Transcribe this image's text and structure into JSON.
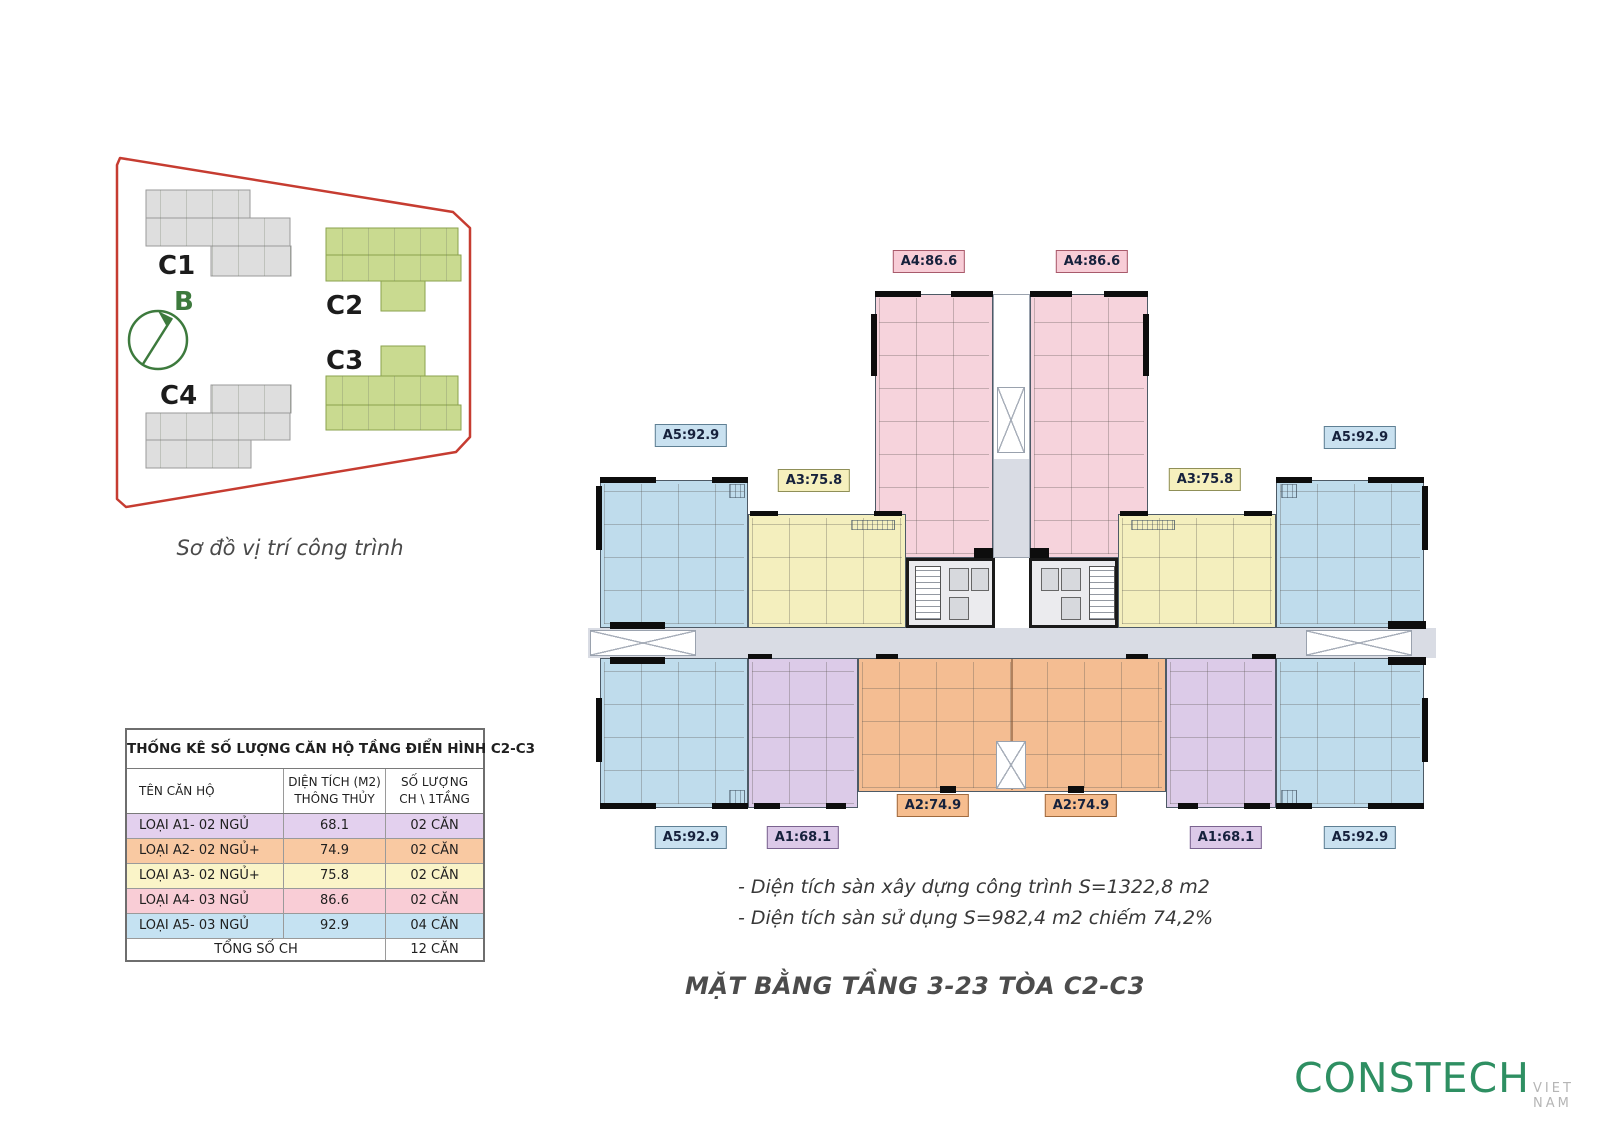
{
  "site": {
    "caption": "Sơ đồ vị trí công trình",
    "compass_label": "B",
    "buildings": [
      {
        "id": "C1",
        "style": "gray"
      },
      {
        "id": "C2",
        "style": "green"
      },
      {
        "id": "C3",
        "style": "green"
      },
      {
        "id": "C4",
        "style": "gray"
      }
    ],
    "boundary_color": "#c63c31"
  },
  "table": {
    "title": "THỐNG KÊ SỐ LƯỢNG CĂN HỘ TẦNG ĐIỂN HÌNH C2-C3",
    "col1": "TÊN CĂN HỘ",
    "col2_line1": "DIỆN TÍCH (M2)",
    "col2_line2": "THÔNG THỦY",
    "col3_line1": "SỐ LƯỢNG",
    "col3_line2": "CH \\ 1TẦNG",
    "rows": [
      {
        "name": "LOẠI A1- 02 NGỦ",
        "area": "68.1",
        "count": "02 CĂN",
        "color": "#e3d0ee"
      },
      {
        "name": "LOẠI A2- 02 NGỦ+",
        "area": "74.9",
        "count": "02 CĂN",
        "color": "#f9c9a2"
      },
      {
        "name": "LOẠI A3- 02 NGỦ+",
        "area": "75.8",
        "count": "02 CĂN",
        "color": "#faf4c8"
      },
      {
        "name": "LOẠI A4- 03 NGỦ",
        "area": "86.6",
        "count": "02 CĂN",
        "color": "#f9cdd6"
      },
      {
        "name": "LOẠI A5- 03 NGỦ",
        "area": "92.9",
        "count": "04 CĂN",
        "color": "#c5e2f2"
      }
    ],
    "footer_label": "TỔNG SỐ CH",
    "footer_count": "12 CĂN"
  },
  "plan": {
    "labels": [
      {
        "id": "a4-left",
        "text": "A4:86.6"
      },
      {
        "id": "a4-right",
        "text": "A4:86.6"
      },
      {
        "id": "a5-top-left",
        "text": "A5:92.9"
      },
      {
        "id": "a5-top-right",
        "text": "A5:92.9"
      },
      {
        "id": "a3-left",
        "text": "A3:75.8"
      },
      {
        "id": "a3-right",
        "text": "A3:75.8"
      },
      {
        "id": "a2-left",
        "text": "A2:74.9"
      },
      {
        "id": "a2-right",
        "text": "A2:74.9"
      },
      {
        "id": "a1-left",
        "text": "A1:68.1"
      },
      {
        "id": "a1-right",
        "text": "A1:68.1"
      },
      {
        "id": "a5-bottom-left",
        "text": "A5:92.9"
      },
      {
        "id": "a5-bottom-right",
        "text": "A5:92.9"
      }
    ],
    "notes": [
      "- Diện tích sàn xây dựng công trình S=1322,8 m2",
      "- Diện tích sàn sử dụng S=982,4 m2 chiếm 74,2%"
    ],
    "title": "MẶT BẰNG TẦNG 3-23 TÒA C2-C3"
  },
  "logo": {
    "brand": "CONSTECH",
    "suffix": "VIET NAM"
  },
  "colors": {
    "unit_a1_purple": "#dccbe8",
    "unit_a2_orange": "#f4bd92",
    "unit_a3_yellow": "#f4efbe",
    "unit_a4_pink": "#f6d3dc",
    "unit_a5_blue": "#bfdcec",
    "corridor_gray": "#d9dce4",
    "boundary_red": "#c63c31",
    "building_green": "#c9da90",
    "building_gray": "#dedede",
    "compass_green": "#3d7a3d",
    "logo_green": "#2e8f62"
  }
}
